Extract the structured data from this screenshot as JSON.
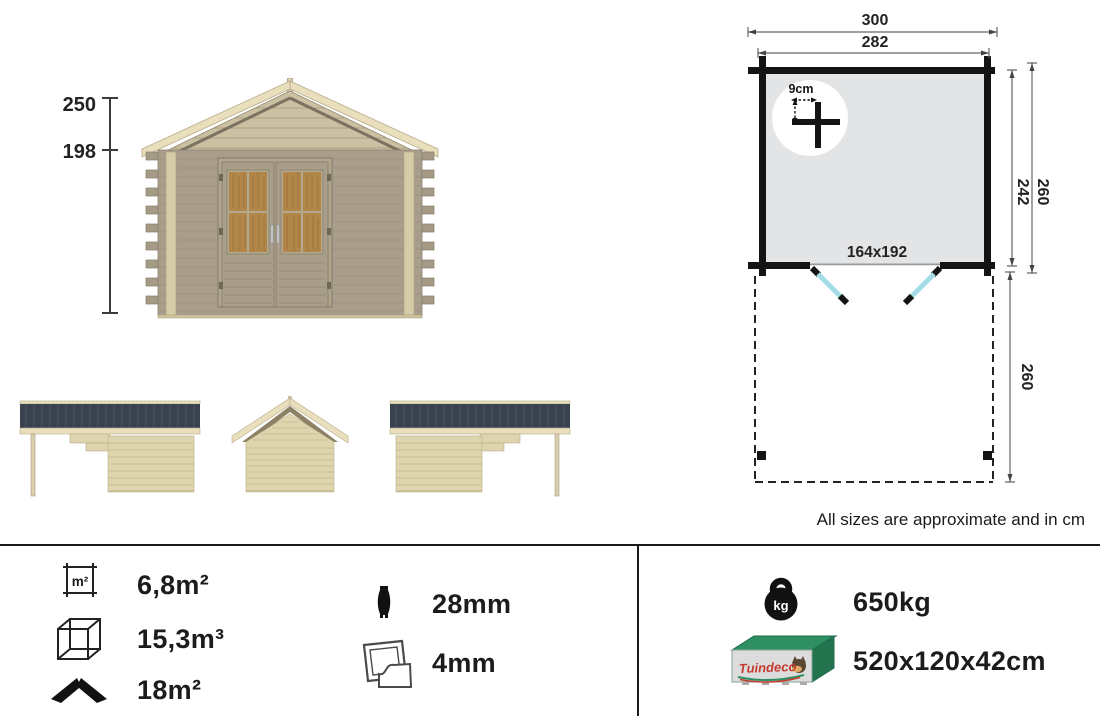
{
  "colors": {
    "roof_dark": "#3a4250",
    "wood_light": "#ded4ae",
    "wood_cream": "#e9dfbc",
    "wall_taupe": "#a89e8b",
    "window_amber": "#b28549",
    "door_swing_blue": "#a5dce8",
    "plan_floor_gray": "#e3e4e6",
    "package_green": "#2e8f63",
    "brand_red": "#c43b2e",
    "line_black": "#1a1a1a"
  },
  "front_view": {
    "total_height": "250",
    "wall_height": "198"
  },
  "floor_plan": {
    "roof_width": "300",
    "outer_width": "282",
    "inner_depth": "242",
    "outer_depth": "260",
    "terrace_depth": "260",
    "door_opening": "164x192",
    "log_detail": "9cm"
  },
  "note": "All sizes are approximate and in cm",
  "specs": {
    "area": {
      "icon_label": "m²",
      "value": "6,8m²"
    },
    "volume": {
      "value": "15,3m³"
    },
    "roof_area": {
      "value": "18m²"
    },
    "wall_thickness": {
      "value": "28mm"
    },
    "glazing": {
      "value": "4mm"
    },
    "weight": {
      "icon_label": "kg",
      "value": "650kg"
    },
    "package": {
      "brand": "Tuindeco",
      "value": "520x120x42cm"
    }
  }
}
